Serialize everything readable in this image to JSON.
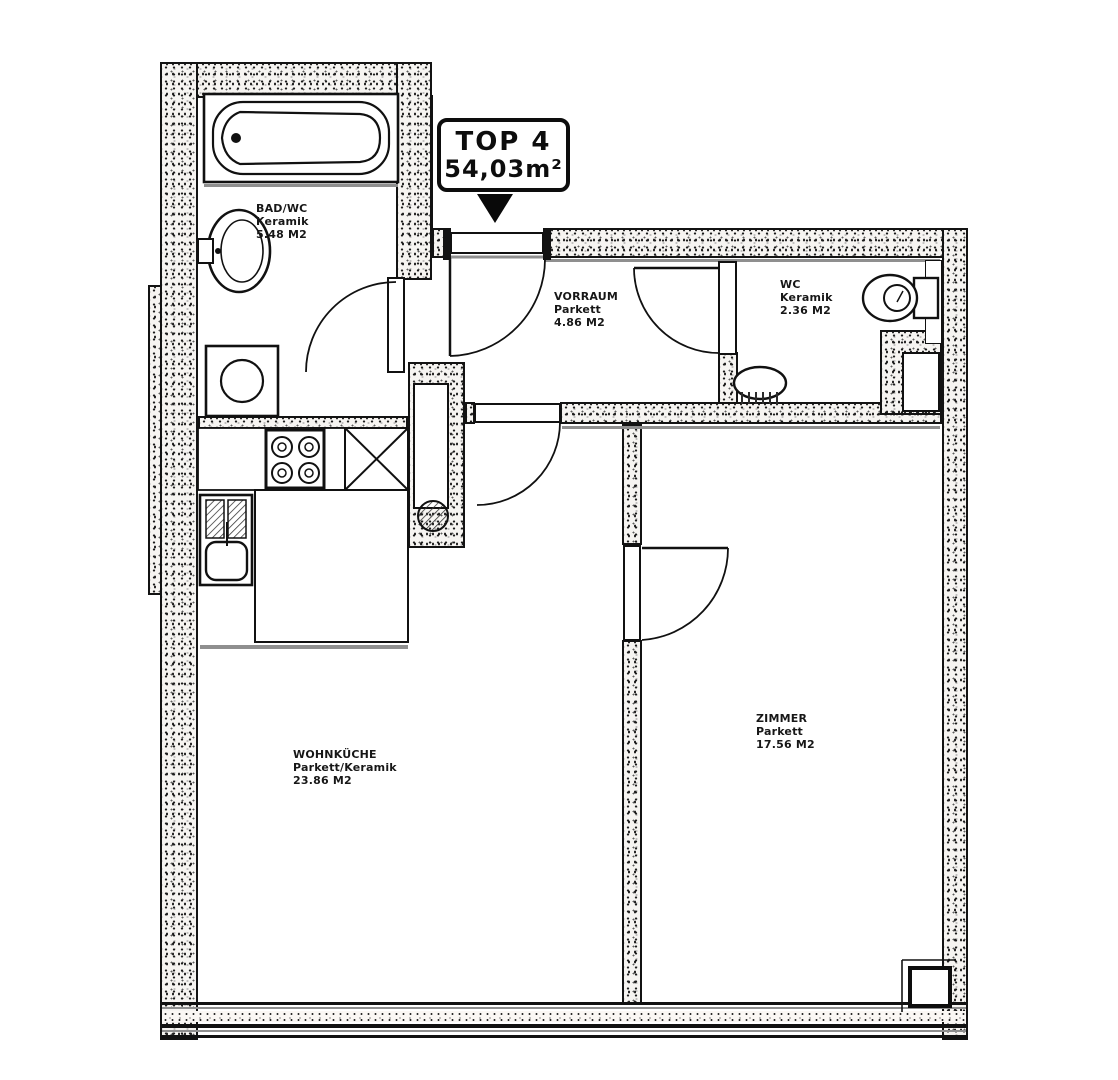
{
  "document": {
    "kind": "apartment floor plan (scanned)",
    "colors": {
      "ink": "#141414",
      "gray_line": "#8f8f8f",
      "paper": "#ffffff"
    }
  },
  "title_box": {
    "unit": "TOP 4",
    "area": "54,03m²"
  },
  "rooms": [
    {
      "name": "BAD/WC",
      "floor": "Keramik",
      "area": "5.48 M2"
    },
    {
      "name": "VORRAUM",
      "floor": "Parkett",
      "area": "4.86 M2"
    },
    {
      "name": "WC",
      "floor": "Keramik",
      "area": "2.36 M2"
    },
    {
      "name": "WOHNKÜCHE",
      "floor": "Parkett/Keramik",
      "area": "23.86 M2"
    },
    {
      "name": "ZIMMER",
      "floor": "Parkett",
      "area": "17.56 M2"
    }
  ],
  "fixtures": [
    "bathtub-icon",
    "bath-sink-icon",
    "washing-machine-icon",
    "kitchen-sink-icon",
    "stove-hob-icon",
    "cabinet-x-icon",
    "kitchen-block",
    "toilet-icon",
    "wc-washbasin-icon",
    "service-shaft-icon",
    "entrance-pointer-icon",
    "door-swing-icon",
    "window-band"
  ]
}
